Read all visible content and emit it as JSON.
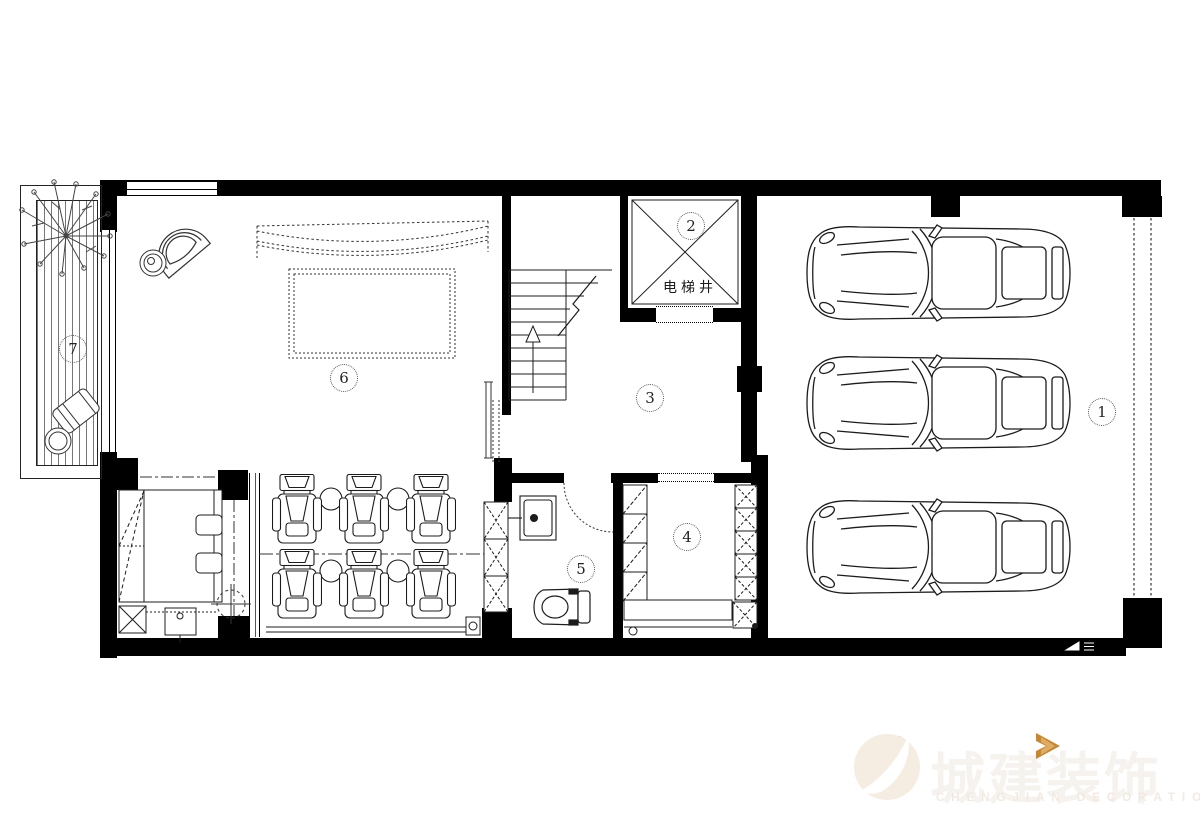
{
  "floorplan": {
    "rooms": [
      {
        "num": "1"
      },
      {
        "num": "2"
      },
      {
        "num": "3"
      },
      {
        "num": "4"
      },
      {
        "num": "5"
      },
      {
        "num": "6"
      },
      {
        "num": "7"
      }
    ],
    "elevator_shaft_label": "电梯井"
  },
  "watermark": {
    "brand_cn": "城建装饰",
    "brand_en": "CHENGJIAN DECORATION",
    "accent_color": "#C8872E"
  },
  "colors": {
    "wall": "#000000",
    "line": "#1c1c1c",
    "background": "#ffffff"
  }
}
